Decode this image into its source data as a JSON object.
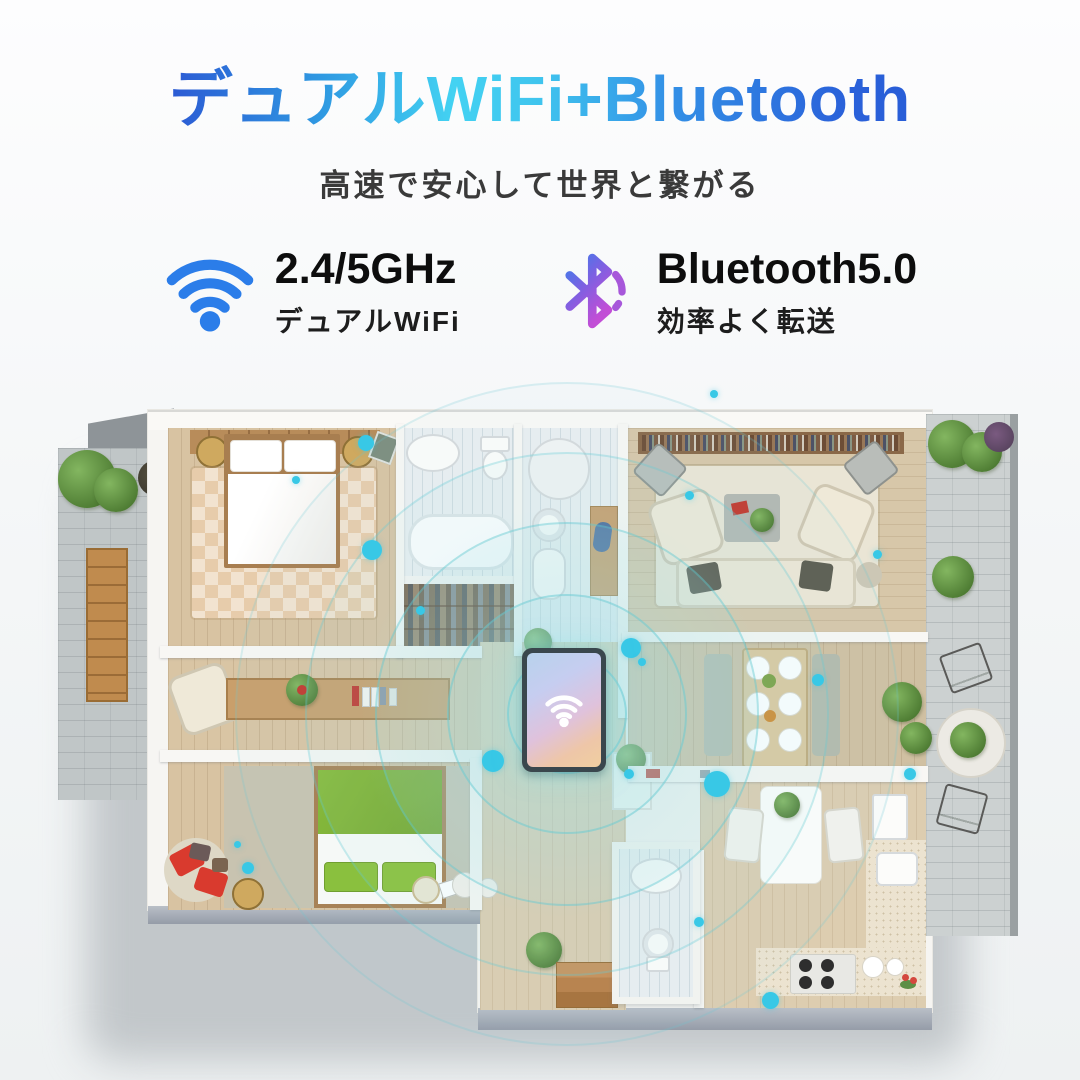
{
  "title": {
    "text": "デュアルWiFi+Bluetooth"
  },
  "subtitle": {
    "text": "高速で安心して世界と繋がる"
  },
  "features": {
    "wifi": {
      "heading": "2.4/5GHz",
      "caption": "デュアルWiFi"
    },
    "bluetooth": {
      "heading": "Bluetooth5.0",
      "caption": "効率よく転送"
    }
  },
  "colors": {
    "title_gradient_start": "#2a38c6",
    "title_gradient_mid": "#43d2f2",
    "title_gradient_end": "#2450d0",
    "wifi_icon": "#2b7de9",
    "bluetooth_icon_top": "#3f7cea",
    "bluetooth_icon_bottom": "#c24ed6",
    "signal_dot": "#38c8e6"
  }
}
